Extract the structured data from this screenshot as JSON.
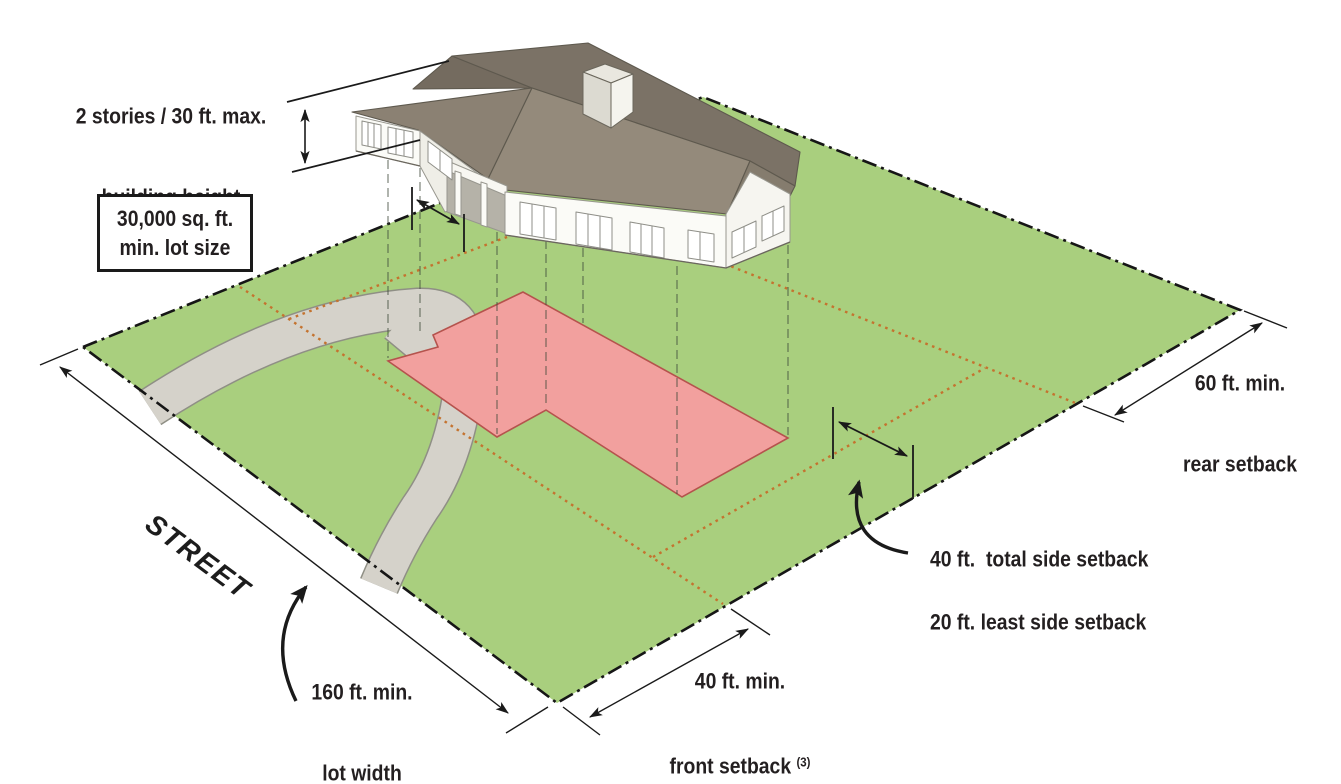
{
  "labels": {
    "building_height": {
      "line1": "2 stories / 30 ft. max.",
      "line2": "building height"
    },
    "lot_size": {
      "line1": "30,000 sq. ft.",
      "line2": "min. lot size"
    },
    "street": "STREET",
    "lot_width": {
      "line1": "160 ft. min.",
      "line2": "lot width"
    },
    "front_setback": {
      "line1": "40 ft. min.",
      "line2": "front setback",
      "footnote": "(3)"
    },
    "total_side_setback": "40 ft.  total side setback",
    "least_side_setback": "20 ft. least side setback",
    "rear_setback": {
      "line1": "60 ft. min.",
      "line2": "rear setback"
    }
  },
  "zoning_requirements": {
    "max_building_height": "2 stories / 30 ft.",
    "min_lot_size": "30,000 sq. ft.",
    "min_lot_width": "160 ft.",
    "min_front_setback": "40 ft.",
    "total_side_setback": "40 ft.",
    "least_side_setback": "20 ft.",
    "min_rear_setback": "60 ft."
  },
  "colors": {
    "lot_green": "#a9cf7e",
    "driveway_gray": "#d5d2ca",
    "building_footprint_pink": "#f2a09e",
    "footprint_outline": "#b5534d",
    "setback_dotted_line": "#c4732f",
    "roof_gray": "#8b8173",
    "ink": "#231f20"
  }
}
